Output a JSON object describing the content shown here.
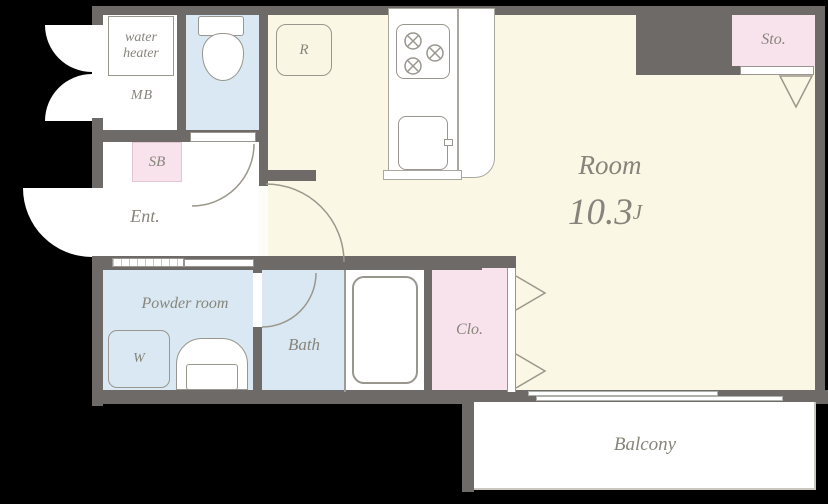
{
  "floorplan": {
    "rooms": {
      "water_heater": {
        "label": "water heater"
      },
      "meter_box": {
        "label": "MB"
      },
      "refrigerator": {
        "label": "R"
      },
      "storage": {
        "label": "Sto."
      },
      "shoe_box": {
        "label": "SB"
      },
      "entrance": {
        "label": "Ent."
      },
      "main_room": {
        "label": "Room",
        "size_value": "10.3",
        "size_unit": "J"
      },
      "powder_room": {
        "label": "Powder room"
      },
      "washer": {
        "label": "W"
      },
      "bath": {
        "label": "Bath"
      },
      "closet": {
        "label": "Clo."
      },
      "balcony": {
        "label": "Balcony"
      }
    },
    "colors": {
      "background": "#000000",
      "wall": "#6D6A68",
      "floor_main": "#FAF7E5",
      "floor_wet": "#D9E8F3",
      "floor_closet": "#F8E3ED",
      "floor_white": "#FFFFFF",
      "label_text": "#87857B",
      "fixture_outline": "#98968E"
    }
  }
}
